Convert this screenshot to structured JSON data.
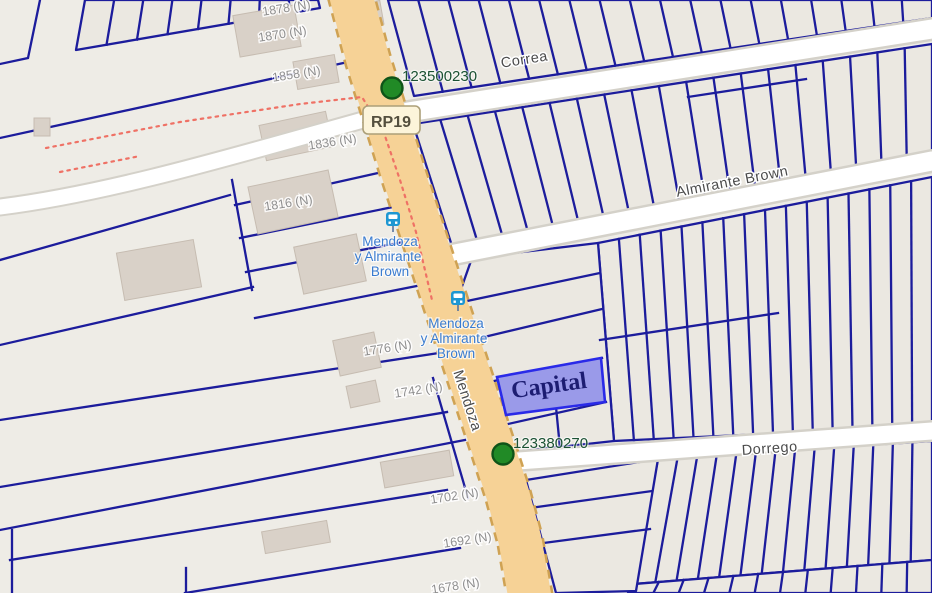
{
  "map": {
    "streets": {
      "correa": "Correa",
      "almirante_brown": "Almirante Brown",
      "dorrego": "Dorrego",
      "mendoza": "Mendoza"
    },
    "route_badge": "RP19",
    "highlighted_parcel": {
      "label": "Capital",
      "fill": "#9a9ae9",
      "border": "#2a2ae8"
    },
    "markers": [
      {
        "id": "123500230",
        "color": "#218a26"
      },
      {
        "id": "123380270",
        "color": "#218a26"
      }
    ],
    "bus_stops": [
      {
        "name_lines": [
          "Mendoza",
          "y Almirante",
          "Brown"
        ]
      },
      {
        "name_lines": [
          "Mendoza",
          "y Almirante",
          "Brown"
        ]
      }
    ],
    "address_labels": [
      "1878 (N)",
      "1870 (N)",
      "1858 (N)",
      "1836 (N)",
      "1816 (N)",
      "1776 (N)",
      "1742 (N)",
      "1702 (N)",
      "1692 (N)",
      "1678 (N)"
    ],
    "colors": {
      "land": "#eeece6",
      "parcel_outline": "#1c1c9c",
      "road_fill": "#ffffff",
      "primary_road": "#f6d296",
      "building": "#d9d1c8",
      "marker_green": "#218a26",
      "marker_label": "#1b5233",
      "bus_blue": "#1e97d2",
      "bus_label": "#3a7cd0",
      "boundary_red": "#ef7165"
    }
  }
}
